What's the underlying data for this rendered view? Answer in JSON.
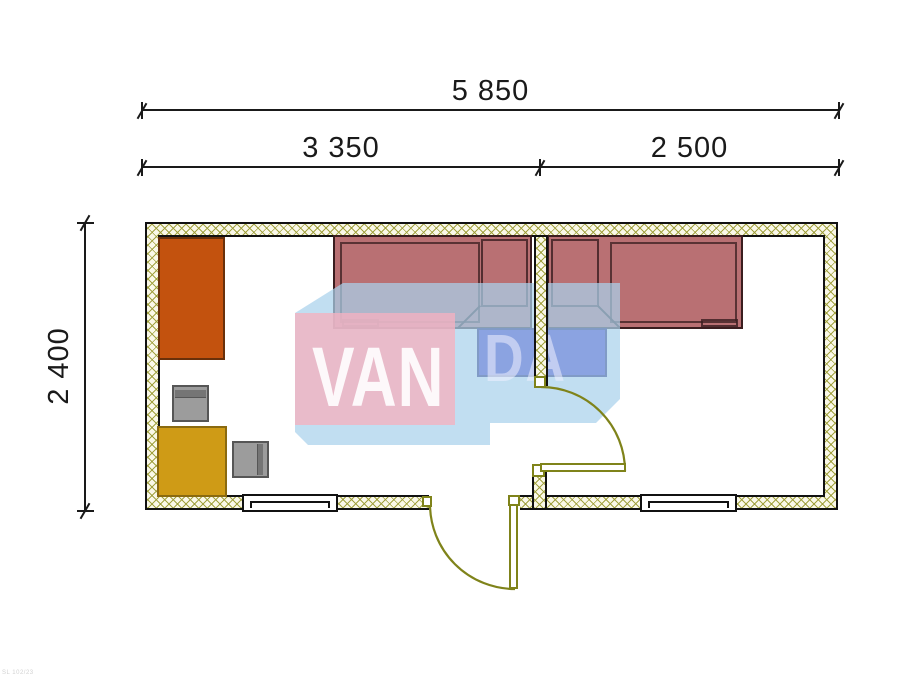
{
  "drawing": {
    "type": "floor-plan",
    "dimensions": {
      "overall_width": "5 850",
      "left_room_width": "3 350",
      "right_room_width": "2 500",
      "depth": "2 400"
    },
    "watermark": {
      "text": "VANDA",
      "part_van": "VAN",
      "part_da": "DA",
      "pink_color": "#f3b2c0",
      "blue_color": "#aad2ec"
    },
    "stamp": "SL 102/23",
    "colors": {
      "wall_hatch_line": "#9e9e38",
      "wall_fill": "#faf8e8",
      "wall_outline": "#111111",
      "bed": "#b97073",
      "bed_outline": "#3a1d1f",
      "nightstand": "#3e2ec5",
      "wardrobe": "#c3520e",
      "table": "#cf9b16",
      "chair": "#9c9c9c",
      "door": "#7f831a",
      "dimension_text": "#1a1a1a"
    },
    "rooms": [
      {
        "name": "bedroom-left",
        "width_label": "3 350"
      },
      {
        "name": "bedroom-right",
        "width_label": "2 500"
      }
    ],
    "furniture": [
      "wardrobe",
      "chair",
      "chair",
      "table",
      "single-bed-left",
      "single-bed-right",
      "nightstand-left",
      "nightstand-right"
    ]
  }
}
